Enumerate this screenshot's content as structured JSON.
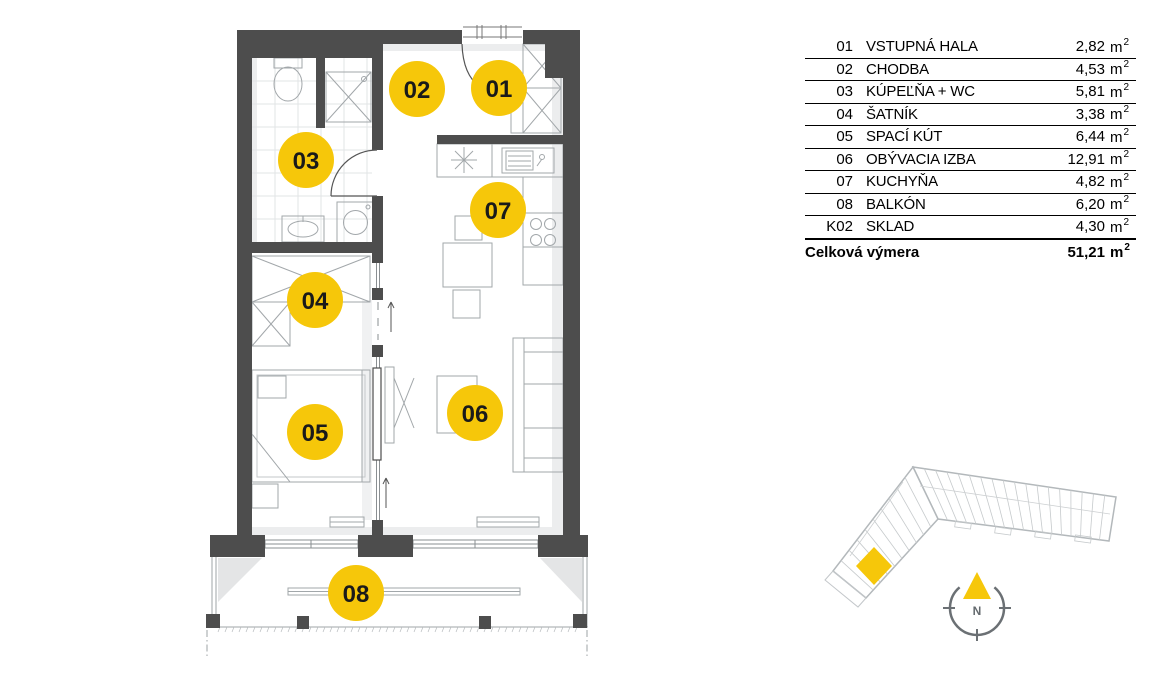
{
  "legend": {
    "rows": [
      {
        "code": "01",
        "name": "VSTUPNÁ HALA",
        "area": "2,82"
      },
      {
        "code": "02",
        "name": "CHODBA",
        "area": "4,53"
      },
      {
        "code": "03",
        "name": "KÚPEĽŇA + WC",
        "area": "5,81"
      },
      {
        "code": "04",
        "name": "ŠATNÍK",
        "area": "3,38"
      },
      {
        "code": "05",
        "name": "SPACÍ KÚT",
        "area": "6,44"
      },
      {
        "code": "06",
        "name": "OBÝVACIA IZBA",
        "area": "12,91"
      },
      {
        "code": "07",
        "name": "KUCHYŇA",
        "area": "4,82"
      },
      {
        "code": "08",
        "name": "BALKÓN",
        "area": "6,20"
      },
      {
        "code": "K02",
        "name": "SKLAD",
        "area": "4,30"
      }
    ],
    "unit_base": "m",
    "unit_exp": "2",
    "total": {
      "label": "Celková výmera",
      "area": "51,21"
    }
  },
  "floorplan": {
    "bubbles": [
      {
        "label": "01"
      },
      {
        "label": "02"
      },
      {
        "label": "03"
      },
      {
        "label": "04"
      },
      {
        "label": "05"
      },
      {
        "label": "06"
      },
      {
        "label": "07"
      },
      {
        "label": "08"
      }
    ]
  },
  "compass": {
    "north_label": "N"
  },
  "colors": {
    "accent_yellow": "#F6C70A",
    "wall_gray": "#4D4D4D"
  }
}
